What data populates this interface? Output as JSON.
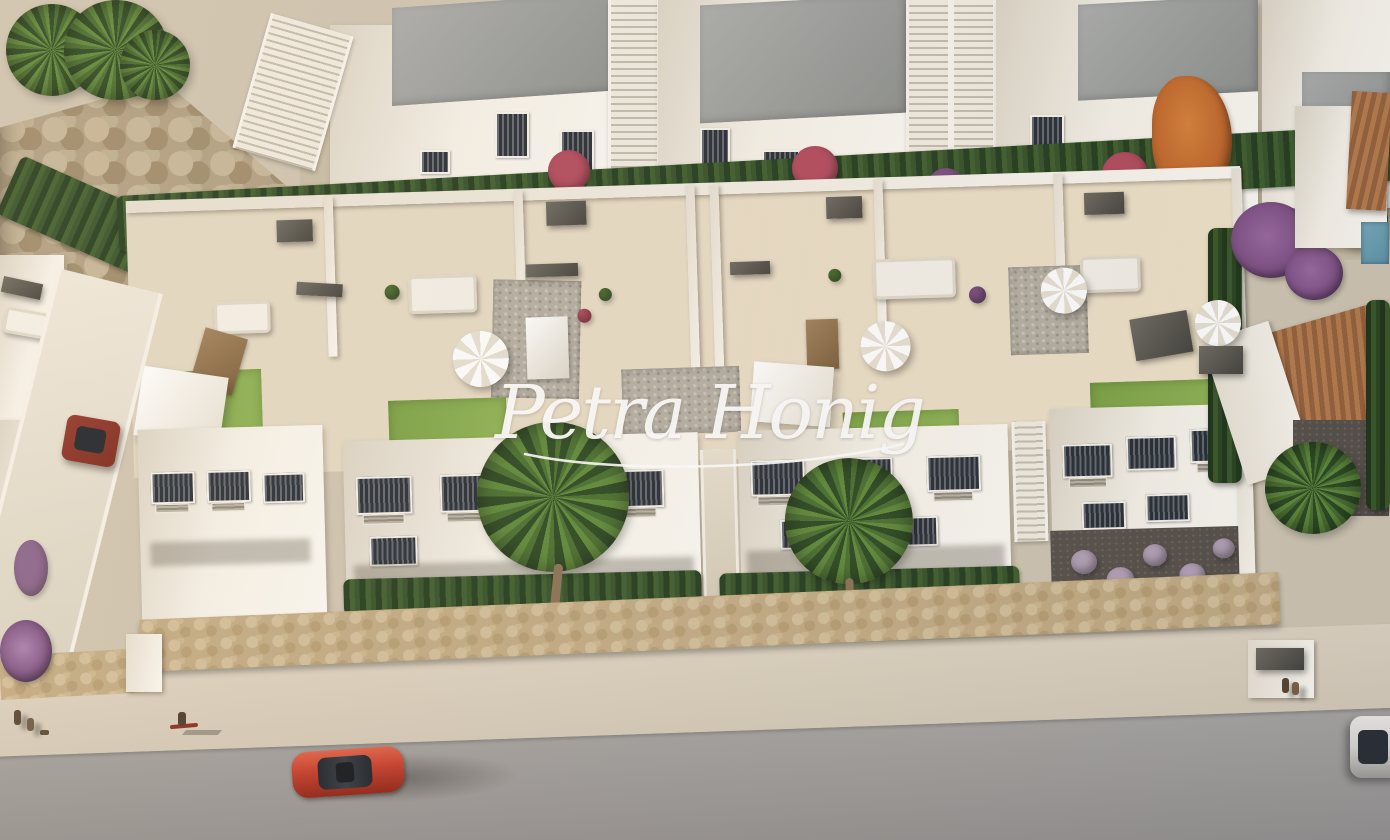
{
  "watermark": {
    "text": "Petra Honig"
  },
  "palette": {
    "white": "#f6f2e9",
    "whiteHi": "#fcfaf4",
    "whiteShade": "#dcd5c6",
    "roof": "#abadac",
    "roofDark": "#8e918e",
    "glass": "#272e36",
    "hedge": "#3f5e2c",
    "hedgeDark": "#243d1e",
    "lawn": "#7ba245",
    "lawnLight": "#90b455",
    "palm": "#4a7030",
    "palmDark": "#2c4a22",
    "flowerRed": "#b34b5e",
    "flowerPurple": "#7c4f82",
    "lavender": "#b3a0b5",
    "orangeTree": "#c2682b",
    "terracotta": "#b57b4e",
    "terracottaDark": "#96613a",
    "pool": "#5d93a8",
    "carRed": "#c23a28",
    "carRedDark": "#7c281c",
    "carSilver": "#d6d5d2",
    "road": "#a9a7a4",
    "roadDark": "#949190",
    "sidewalk": "#d4cab8",
    "stoneWall": "#c2ab84",
    "deck": "#e8dec8",
    "watermark": "rgba(255,255,255,0.95)",
    "shadow": "rgba(40,35,25,0.30)"
  }
}
